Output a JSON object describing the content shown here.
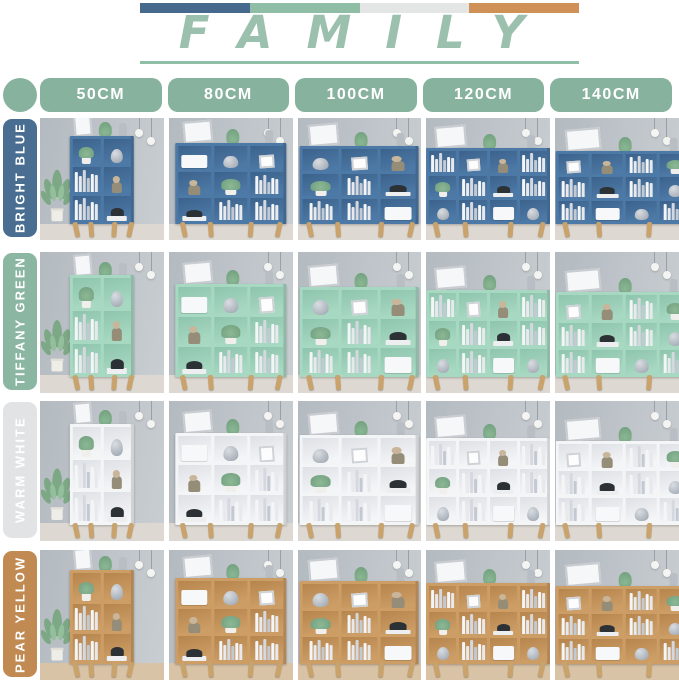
{
  "header": {
    "title": "FAMILY",
    "accent": "#9cc0ae",
    "underline_color": "#8fbfa6",
    "bar_colors": [
      "#47698e",
      "#8fbda6",
      "#e4e6e5",
      "#cf9156"
    ]
  },
  "size_header": {
    "dot_color": "#87b29d",
    "button_color": "#87b29d",
    "button_text_color": "#ffffff",
    "sizes": [
      {
        "label": "50CM",
        "cols": 2,
        "shelf_rows": 3,
        "case_width_pct": 52,
        "case_height_pct": 72
      },
      {
        "label": "80CM",
        "cols": 3,
        "shelf_rows": 3,
        "case_width_pct": 90,
        "case_height_pct": 66
      },
      {
        "label": "100CM",
        "cols": 3,
        "shelf_rows": 3,
        "case_width_pct": 96,
        "case_height_pct": 64
      },
      {
        "label": "120CM",
        "cols": 4,
        "shelf_rows": 3,
        "case_width_pct": 100,
        "case_height_pct": 62
      },
      {
        "label": "140CM",
        "cols": 4,
        "shelf_rows": 3,
        "case_width_pct": 112,
        "case_height_pct": 60
      }
    ]
  },
  "rows": [
    {
      "name": "BRIGHT BLUE",
      "slug": "bright-blue",
      "label_bg": "#4a6e91",
      "label_fg": "#ffffff",
      "case_color": "#4d79a6",
      "case_shade": "#3b628b",
      "floor": "#ddd8d1"
    },
    {
      "name": "TIFFANY GREEN",
      "slug": "tiffany-green",
      "label_bg": "#8bb6a1",
      "label_fg": "#ffffff",
      "case_color": "#a7d8c2",
      "case_shade": "#8ec4ad",
      "floor": "#ddd8d1"
    },
    {
      "name": "WARM WHITE",
      "slug": "warm-white",
      "label_bg": "#e1e3e4",
      "label_fg": "#ffffff",
      "case_color": "#f4f5f7",
      "case_shade": "#dde0e5",
      "floor": "#ddd8d1"
    },
    {
      "name": "PEAR YELLOW",
      "slug": "pear-yellow",
      "label_bg": "#c18a52",
      "label_fg": "#ffffff",
      "case_color": "#cd9d66",
      "case_shade": "#b5854d",
      "floor": "#d8c3a6"
    }
  ],
  "scene": {
    "wall_top": "#b3bac0",
    "wall_bottom": "#c9ced2",
    "leg_color": "#c9a36b",
    "book_colors": [
      "#f4f5f7",
      "#e7e9ec",
      "#d5d9df",
      "#c3c9d2"
    ]
  }
}
